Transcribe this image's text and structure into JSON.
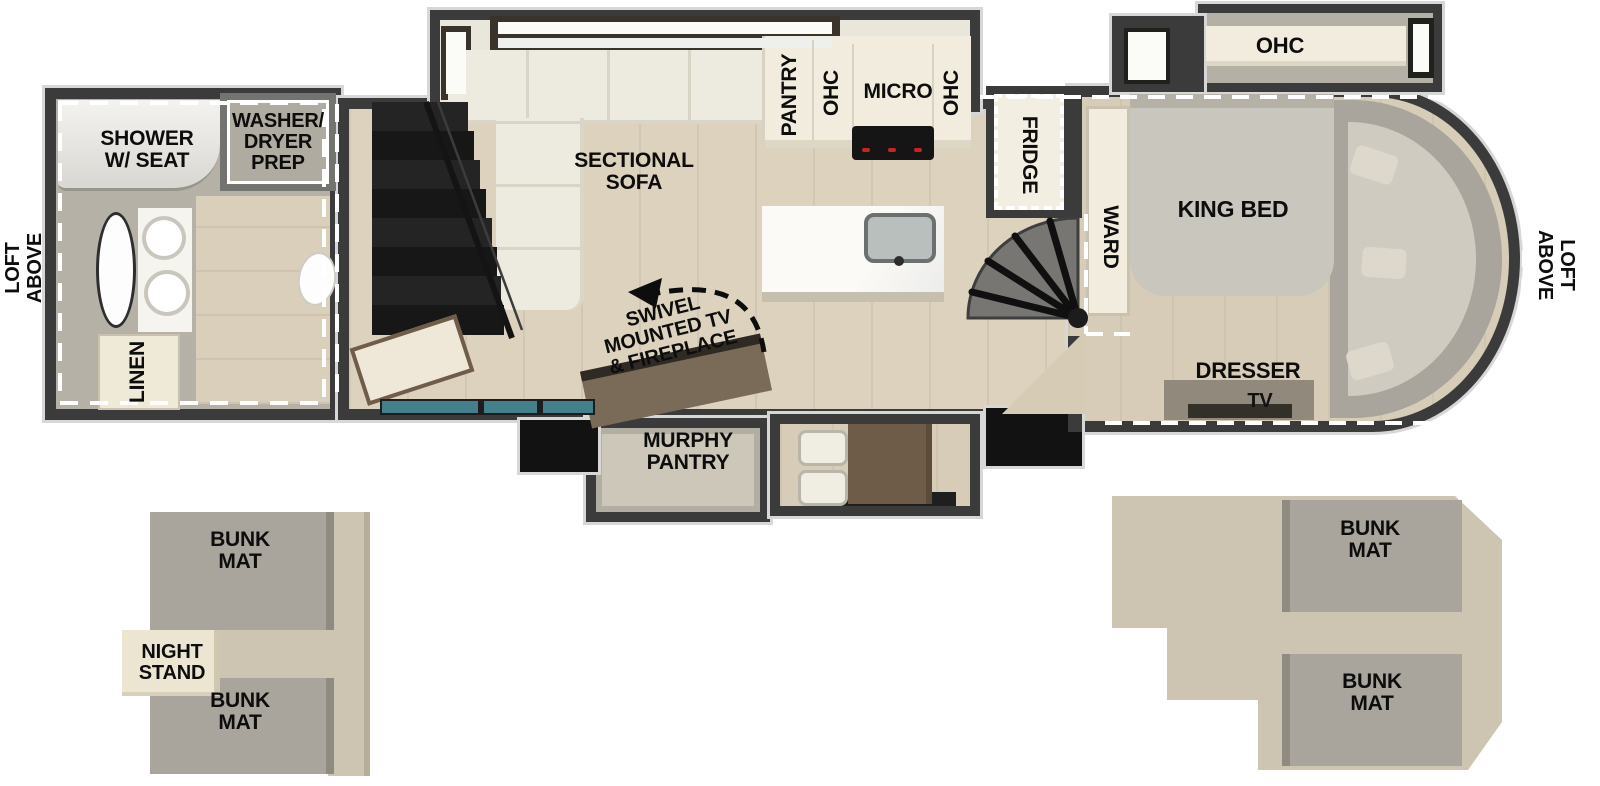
{
  "labels": {
    "loft_left": "LOFT\nABOVE",
    "loft_right": "LOFT\nABOVE",
    "shower": "SHOWER\nW/ SEAT",
    "washer_dryer": "WASHER/\nDRYER\nPREP",
    "linen": "LINEN",
    "sectional_sofa": "SECTIONAL\nSOFA",
    "swivel_tv": "SWIVEL\nMOUNTED TV\n& FIREPLACE",
    "murphy_pantry": "MURPHY\nPANTRY",
    "pantry": "PANTRY",
    "ohc_left": "OHC",
    "micro": "MICRO",
    "ohc_right": "OHC",
    "fridge": "FRIDGE",
    "ward": "WARD",
    "king_bed": "KING BED",
    "ohc_bedroom": "OHC",
    "dresser": "DRESSER",
    "tv": "TV",
    "bunk_mat": "BUNK\nMAT",
    "night_stand": "NIGHT\nSTAND"
  },
  "colors": {
    "wall": "#3b3b3b",
    "wood_floor": "#dcd2bd",
    "bath_floor": "#b6b1a6",
    "cabinet_cream": "#f1ecdd",
    "sofa": "#edeae0",
    "stairs_black": "#1c1c1c",
    "window_teal": "#44808c",
    "bunk_gray": "#a9a59c",
    "platform_beige": "#cdc5b2",
    "wood_brown": "#6f5c48",
    "label_text": "#0d0d0d",
    "loft_dash": "#ffffff"
  }
}
